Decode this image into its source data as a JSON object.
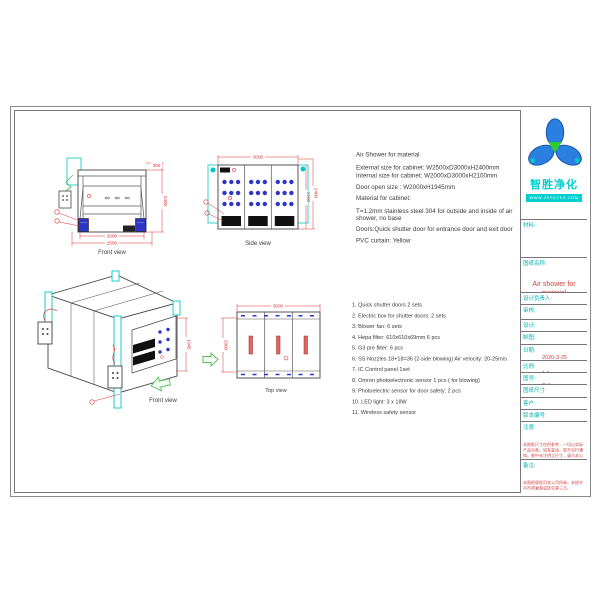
{
  "specs": {
    "title": "Air Shower for material",
    "lines": [
      "External size for cabinet:  W2500xD3000xH2400mm",
      "Internal size for cabinet:  W2000xD3000xH2100mm",
      "Door open size : W2000xH1945mm",
      "Material for cabinet:",
      "T=1.2mm stainless steel 304 for outside and inside of air shower, no base",
      "Doors:Quick shutter door for entrance door and exit door",
      "PVC curtain: Yellow"
    ]
  },
  "parts_list": [
    "1. Quick shutter doors    2 sets",
    "2. Electric box for shutter doors: 2 sets",
    "3. Blower fan: 6 sets",
    "4. Hepa filter: 610x610x69mm 6 pcs",
    "5. G3 pre filter:  6 pcs",
    "6. SS Nozzles  18+18=36 (2-side blowing)  Air velocity: 20-25m/s",
    "7. IC Control panel    1set",
    "8. Omron photoelectronic sensor    1 pcs ( for blowing)",
    "9. Photoelectric sensor for door safety: 2 pcs",
    "10. LED light: 3 x 18W",
    "11. Wireless safety sensor"
  ],
  "views": {
    "front": {
      "label": "Front view",
      "dim_top": "300",
      "dim_height": "2400",
      "dim_width_inner": "2000",
      "dim_width_outer": "2500"
    },
    "side": {
      "label": "Side view",
      "dim_width": "3000",
      "dim_height_inner": "2100",
      "dim_height_outer": "2400"
    },
    "top": {
      "label": "Top view",
      "dim_width": "3000",
      "dim_depth": "2000"
    },
    "iso": {
      "label": "Front view",
      "dim_door_height": "1945"
    }
  },
  "title_block": {
    "brand": "智胜净化",
    "website": "WWW.ZSFILTER.COM",
    "material_label": "材料:",
    "drawing_name_label": "图纸名称:",
    "drawing_name": "Air shower for material",
    "designer_label": "设计负责人:",
    "audit_label": "审核:",
    "design_label": "设计:",
    "draft_label": "制图:",
    "date_label": "日期:",
    "date_value": "2020-3-25",
    "scale_label": "比例:",
    "scale_value": "1:1",
    "no_label": "图号:",
    "no_value": "P-1",
    "size_label": "图纸尺寸:",
    "customer_label": "客户:",
    "version_label": "版本编号:",
    "notice_label": "注意:",
    "notice_text": "本图纸尺寸仅供参考，一切以实际产品为准。如有变动，恕不另行通知。图中未注明之尺寸，请与本公司技术部门确认后方可施工。",
    "remark_label": "备注:",
    "remark_text": "本图纸版权归本公司所有，未经许可不得复制或转交第三方。"
  },
  "colors": {
    "accent_cyan": "#00c8c8",
    "dim_red": "#e03030",
    "nozzle_blue": "#2d35c8",
    "arrow_green": "#55bb55"
  }
}
